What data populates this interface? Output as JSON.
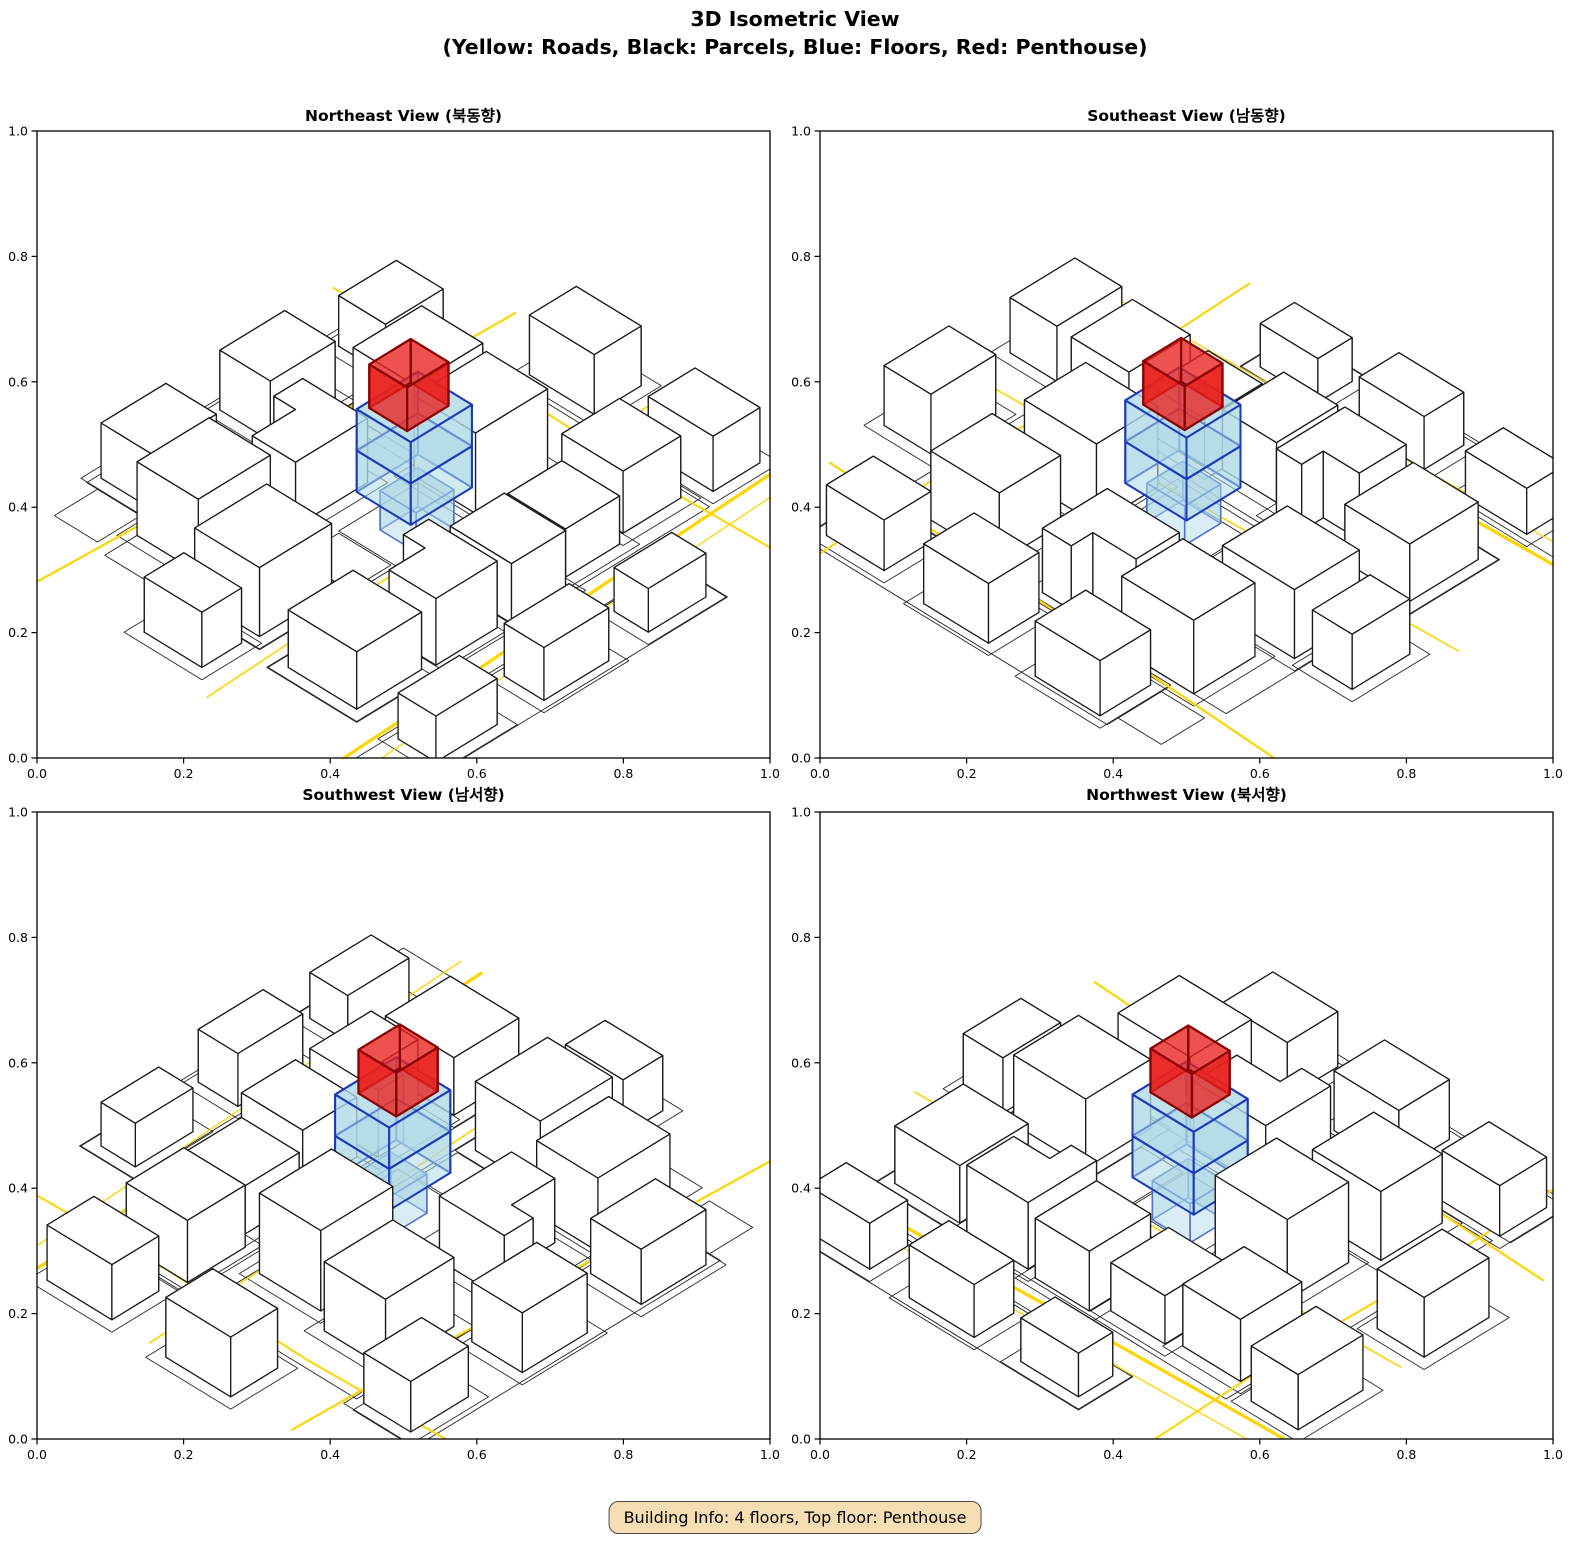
{
  "figure": {
    "title_line1": "3D Isometric View",
    "title_line2": "(Yellow: Roads, Black: Parcels, Blue: Floors, Red: Penthouse)",
    "footer": "Building Info: 4 floors, Top floor: Penthouse"
  },
  "axes": {
    "tick_labels": [
      "0.0",
      "0.2",
      "0.4",
      "0.6",
      "0.8",
      "1.0"
    ],
    "x_range": [
      0.0,
      1.0
    ],
    "y_range": [
      0.0,
      1.0
    ]
  },
  "colors": {
    "road": "#FFD400",
    "building_fill": "#FFFFFF",
    "building_edge": "#1A1A1A",
    "parcel_line": "#222222",
    "floor_fill": "#ADD8E6",
    "floor_edge": "#1C39BB",
    "floor1_edge": "#4D6FD0",
    "penthouse_fill": "#E8211D",
    "penthouse_edge": "#8B0000",
    "axis": "#000000",
    "footer_bg": "#F5DEB3"
  },
  "chart_data": {
    "type": "3d_isometric_wireframe_multiview",
    "title": "3D Isometric View",
    "subtitle": "(Yellow: Roads, Black: Parcels, Blue: Floors, Red: Penthouse)",
    "legend": {
      "yellow": "Roads",
      "black": "Parcels",
      "blue": "Floors",
      "red": "Penthouse"
    },
    "building_info": {
      "floors": 4,
      "top_floor": "Penthouse"
    },
    "axis_ranges": {
      "x": [
        0.0,
        1.0
      ],
      "y": [
        0.0,
        1.0
      ],
      "tick_step": 0.2
    },
    "subplots": [
      {
        "id": "northeast",
        "title": "Northeast View (북동향)",
        "azimuth_deg": 0
      },
      {
        "id": "southeast",
        "title": "Southeast View (남동향)",
        "azimuth_deg": 90
      },
      {
        "id": "southwest",
        "title": "Southwest View (남서향)",
        "azimuth_deg": 180
      },
      {
        "id": "northwest",
        "title": "Northwest View (북서향)",
        "azimuth_deg": 270
      }
    ],
    "scene": {
      "world_size": 10,
      "buildings": [
        {
          "fp": [
            [
              0.3,
              1.6
            ],
            [
              2.1,
              1.6
            ],
            [
              2.1,
              3.5
            ],
            [
              0.3,
              3.5
            ]
          ],
          "h": 1.25
        },
        {
          "fp": [
            [
              2.4,
              1.5
            ],
            [
              4.1,
              1.5
            ],
            [
              4.1,
              3.4
            ],
            [
              3.4,
              3.4
            ],
            [
              3.4,
              2.8
            ],
            [
              2.4,
              2.8
            ]
          ],
          "h": 1.45
        },
        {
          "fp": [
            [
              4.4,
              1.4
            ],
            [
              5.9,
              1.4
            ],
            [
              5.9,
              3.1
            ],
            [
              4.4,
              3.1
            ]
          ],
          "h": 1.3
        },
        {
          "fp": [
            [
              6.2,
              1.7
            ],
            [
              7.7,
              1.7
            ],
            [
              7.7,
              3.3
            ],
            [
              6.2,
              3.3
            ]
          ],
          "h": 1.05
        },
        {
          "fp": [
            [
              8.0,
              1.9
            ],
            [
              9.6,
              1.9
            ],
            [
              9.6,
              3.6
            ],
            [
              8.0,
              3.6
            ]
          ],
          "h": 1.35
        },
        {
          "fp": [
            [
              0.6,
              4.6
            ],
            [
              2.6,
              4.6
            ],
            [
              2.6,
              6.4
            ],
            [
              0.6,
              6.4
            ]
          ],
          "h": 1.5
        },
        {
          "fp": [
            [
              1.2,
              6.9
            ],
            [
              3.2,
              6.9
            ],
            [
              3.2,
              8.6
            ],
            [
              1.2,
              8.6
            ]
          ],
          "h": 1.6
        },
        {
          "fp": [
            [
              3.6,
              6.6
            ],
            [
              5.6,
              6.6
            ],
            [
              5.6,
              8.4
            ],
            [
              4.8,
              8.4
            ],
            [
              4.8,
              7.8
            ],
            [
              3.6,
              7.8
            ]
          ],
          "h": 1.4
        },
        {
          "fp": [
            [
              6.4,
              4.4
            ],
            [
              8.4,
              4.4
            ],
            [
              8.4,
              6.1
            ],
            [
              6.4,
              6.1
            ]
          ],
          "h": 1.75
        },
        {
          "fp": [
            [
              6.9,
              6.6
            ],
            [
              8.8,
              6.6
            ],
            [
              8.8,
              8.3
            ],
            [
              6.9,
              8.3
            ]
          ],
          "h": 1.5
        },
        {
          "fp": [
            [
              2.0,
              9.0
            ],
            [
              3.8,
              9.0
            ],
            [
              3.8,
              10.4
            ],
            [
              2.0,
              10.4
            ]
          ],
          "h": 1.2
        },
        {
          "fp": [
            [
              5.2,
              8.9
            ],
            [
              7.0,
              8.9
            ],
            [
              7.0,
              10.3
            ],
            [
              5.2,
              10.3
            ]
          ],
          "h": 1.3
        },
        {
          "fp": [
            [
              8.3,
              8.8
            ],
            [
              9.9,
              8.8
            ],
            [
              9.9,
              10.1
            ],
            [
              8.3,
              10.1
            ]
          ],
          "h": 1.1
        },
        {
          "fp": [
            [
              0.2,
              -0.7
            ],
            [
              1.9,
              -0.7
            ],
            [
              1.9,
              0.35
            ],
            [
              0.2,
              0.35
            ]
          ],
          "h": 1.0
        },
        {
          "fp": [
            [
              3.1,
              -0.8
            ],
            [
              4.9,
              -0.8
            ],
            [
              4.9,
              0.3
            ],
            [
              3.1,
              0.3
            ]
          ],
          "h": 1.15
        },
        {
          "fp": [
            [
              6.1,
              -0.7
            ],
            [
              7.7,
              -0.7
            ],
            [
              7.7,
              0.25
            ],
            [
              6.1,
              0.25
            ]
          ],
          "h": 0.95
        },
        {
          "fp": [
            [
              -0.9,
              4.7
            ],
            [
              0.2,
              4.7
            ],
            [
              0.2,
              6.3
            ],
            [
              -0.9,
              6.3
            ]
          ],
          "h": 1.2
        },
        {
          "fp": [
            [
              10.2,
              1.6
            ],
            [
              11.5,
              1.6
            ],
            [
              11.5,
              3.4
            ],
            [
              10.2,
              3.4
            ]
          ],
          "h": 1.2
        },
        {
          "fp": [
            [
              10.3,
              5.0
            ],
            [
              11.6,
              5.0
            ],
            [
              11.6,
              6.8
            ],
            [
              10.3,
              6.8
            ]
          ],
          "h": 1.3
        }
      ],
      "roads": [
        {
          "pts": [
            [
              -1.5,
              0.65
            ],
            [
              2.5,
              0.8
            ],
            [
              6.5,
              1.0
            ],
            [
              11.5,
              1.2
            ]
          ],
          "w": 3.2
        },
        {
          "pts": [
            [
              -1.5,
              0.1
            ],
            [
              3.0,
              0.3
            ],
            [
              8.0,
              0.55
            ],
            [
              11.5,
              0.7
            ]
          ],
          "w": 1.3
        },
        {
          "pts": [
            [
              -1.5,
              3.95
            ],
            [
              3.5,
              4.15
            ],
            [
              7.5,
              4.3
            ],
            [
              11.5,
              4.45
            ]
          ],
          "w": 1.6
        },
        {
          "pts": [
            [
              -1.5,
              8.95
            ],
            [
              3.5,
              8.7
            ],
            [
              7.5,
              8.55
            ],
            [
              11.5,
              8.4
            ]
          ],
          "w": 2.2
        },
        {
          "pts": [
            [
              9.75,
              -1.5
            ],
            [
              9.6,
              3.0
            ],
            [
              9.7,
              7.0
            ],
            [
              9.55,
              11.5
            ]
          ],
          "w": 2.0
        }
      ],
      "block_outlines": [
        [
          [
            0.0,
            1.3
          ],
          [
            9.8,
            1.3
          ],
          [
            9.8,
            3.8
          ],
          [
            0.0,
            3.8
          ]
        ],
        [
          [
            0.3,
            4.3
          ],
          [
            9.9,
            4.3
          ],
          [
            9.9,
            8.6
          ],
          [
            0.3,
            8.6
          ]
        ],
        [
          [
            1.7,
            8.8
          ],
          [
            10.2,
            8.8
          ],
          [
            10.2,
            10.5
          ],
          [
            1.7,
            10.5
          ]
        ],
        [
          [
            -1.0,
            -1.0
          ],
          [
            8.0,
            -1.0
          ],
          [
            8.0,
            0.5
          ],
          [
            -1.0,
            0.5
          ]
        ]
      ],
      "extra_parcels": [
        [
          [
            4.1,
            3.95
          ],
          [
            6.3,
            3.95
          ],
          [
            6.3,
            5.9
          ],
          [
            4.1,
            5.9
          ]
        ],
        [
          [
            2.9,
            4.4
          ],
          [
            4.05,
            4.4
          ],
          [
            4.05,
            5.85
          ],
          [
            2.9,
            5.85
          ]
        ],
        [
          [
            0.5,
            9.0
          ],
          [
            1.7,
            9.0
          ],
          [
            1.7,
            10.2
          ],
          [
            0.5,
            10.2
          ]
        ]
      ],
      "target": {
        "floor1": {
          "fp": [
            [
              4.7,
              4.35
            ],
            [
              5.75,
              4.35
            ],
            [
              5.75,
              5.35
            ],
            [
              4.7,
              5.35
            ]
          ],
          "z0": 0,
          "z1": 0.85
        },
        "floor2": {
          "fp": [
            [
              4.35,
              4.15
            ],
            [
              6.05,
              4.15
            ],
            [
              6.05,
              5.65
            ],
            [
              4.35,
              5.65
            ]
          ],
          "z0": 0.85,
          "z1": 1.75
        },
        "floor3": {
          "fp": [
            [
              4.35,
              4.15
            ],
            [
              6.05,
              4.15
            ],
            [
              6.05,
              5.65
            ],
            [
              4.35,
              5.65
            ]
          ],
          "z0": 1.75,
          "z1": 2.65
        },
        "penthouse": {
          "fp": [
            [
              4.55,
              4.45
            ],
            [
              5.7,
              4.45
            ],
            [
              5.7,
              5.5
            ],
            [
              4.55,
              5.5
            ]
          ],
          "z0": 2.65,
          "z1": 3.6
        }
      }
    }
  }
}
